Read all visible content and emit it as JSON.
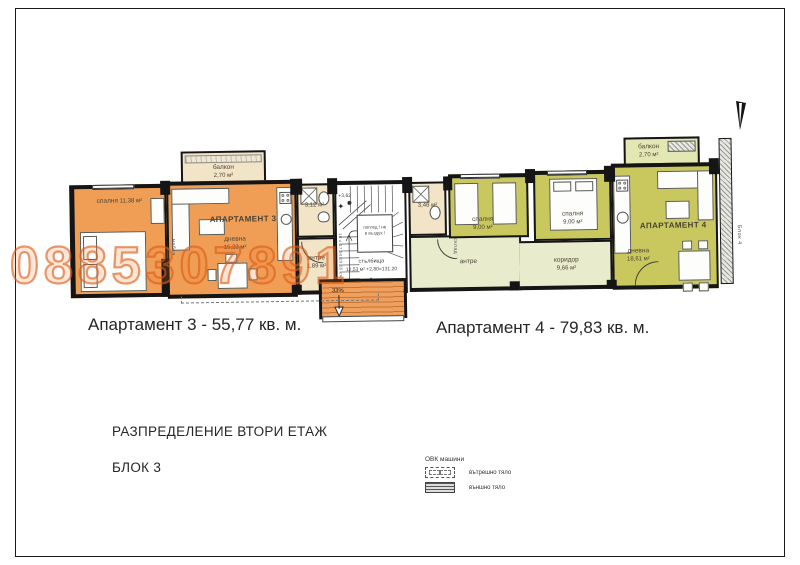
{
  "sheet": {
    "floor_title": "РАЗПРЕДЕЛЕНИЕ ВТОРИ ЕТАЖ",
    "block_title": "БЛОК 3"
  },
  "watermark": "0885307891",
  "captions": {
    "apartment3": "Апартамент 3 - 55,77 кв. м.",
    "apartment4": "Апартамент 4 - 79,83 кв. м."
  },
  "apartment3": {
    "name": "АПАРТАМЕНТ 3",
    "bedroom_label": "спалня",
    "bedroom_area": "11,38 м²",
    "living_label": "дневна",
    "living_area": "15,23 м²",
    "bath_area": "3,12 м²",
    "antre_label": "антре",
    "antre_area": "1,89 м²",
    "balcony_label": "балкон",
    "balcony_area": "2,70 м²",
    "wardrobe_label": "мебел"
  },
  "apartment4": {
    "name": "АПАРТАМЕНТ 4",
    "bedroom1_label": "спалня",
    "bedroom1_area": "9,00 м²",
    "bedroom2_label": "спалня",
    "bedroom2_area": "9,00 м²",
    "living_label": "дневна",
    "living_area": "18,61 м²",
    "corridor_label": "коридор",
    "corridor_area": "9,66 м²",
    "antre_label": "антре",
    "bath_area": "3,46 м²",
    "storage_label": "склад",
    "balcony_label": "балкон",
    "balcony_area": "2,70 м²"
  },
  "stairwell": {
    "label": "стълбища",
    "area": "12,53 м²",
    "calc": "+2,80=131,20",
    "level": "+3,62",
    "note_line1": "поглед ! не",
    "note_line2": "в въздух !",
    "ramp_slope": "33%",
    "stair_dim": "16 х 17,50/29,55 см"
  },
  "adjacent_block": "Блок 4",
  "legend": {
    "title": "ОВК машини",
    "indoor_label": "вътрешно тяло",
    "outdoor_label": "външно тяло"
  },
  "colors": {
    "apartment3_fill": "#f09e56",
    "apartment3_light": "#f2e4c6",
    "apartment4_fill": "#c9c85e",
    "apartment4_light": "#e9ebcd",
    "ramp_fill": "#ef9f5e",
    "watermark": "#dc5c18",
    "wall": "#151515"
  }
}
